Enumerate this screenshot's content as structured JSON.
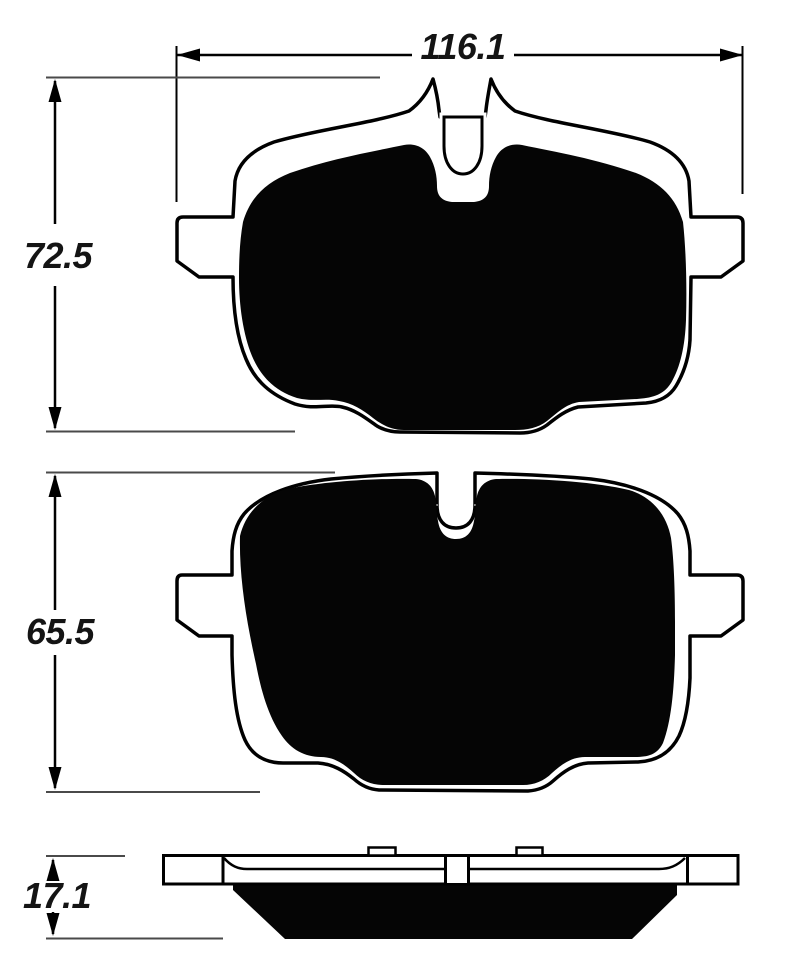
{
  "drawing": {
    "type": "brake-pad-dimensional-drawing",
    "background": "#ffffff",
    "line_color": "#000000",
    "extension_line_color": "#4a4a4a",
    "text_color": "#141414",
    "friction_color": "#050505",
    "views": {
      "top": "pad-front-view-1",
      "middle": "pad-front-view-2",
      "bottom": "pad-side-profile-view"
    },
    "dimensions": {
      "pad_width": "116.1",
      "pad1_height": "72.5",
      "pad2_height": "65.5",
      "pad_thickness": "17.1"
    }
  }
}
